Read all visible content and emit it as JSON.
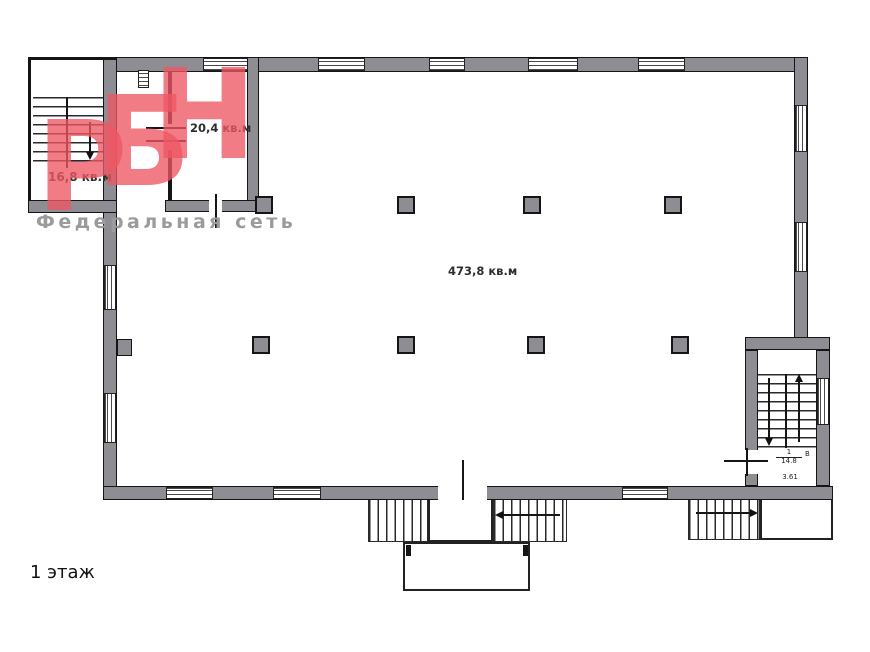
{
  "floor_label": "1 этаж",
  "watermark": {
    "letters": [
      "Р",
      "Б",
      "Н"
    ],
    "subtitle": "Федеральная сеть"
  },
  "rooms": {
    "stair_annex": {
      "area_label": "16,8 кв.м"
    },
    "room_small": {
      "area_label": "20,4 кв.м"
    },
    "hall": {
      "area_label": "473,8 кв.м"
    },
    "stair_lobby": {
      "number": "1",
      "area": "14.8",
      "side_mark": "В",
      "height_mark": "3.61"
    }
  },
  "colors": {
    "wall_fill": "#8d8d93",
    "line": "#151515",
    "watermark_pink": "rgba(237,87,100,0.78)",
    "subtitle_gray": "#9b9b9b"
  }
}
